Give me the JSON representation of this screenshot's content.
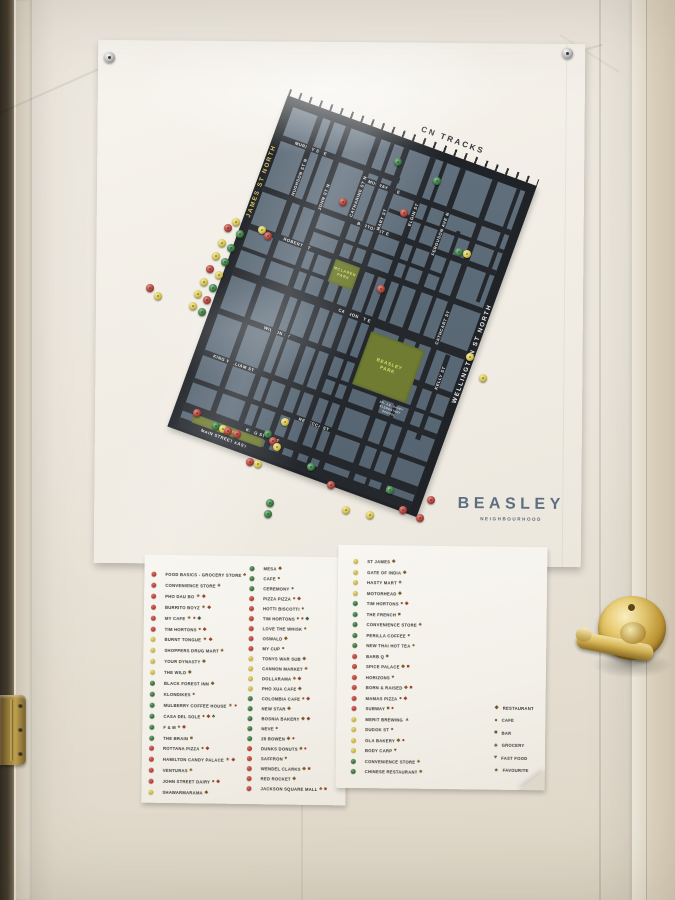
{
  "poster": {
    "title": "BEASLEY",
    "subtitle": "NEIGHBOURHOOD",
    "map": {
      "railway_label": "CN TRACKS",
      "edge_left": "JAMES ST NORTH",
      "edge_right": "WELLINGTON ST NORTH",
      "h_streets": [
        {
          "y": 30,
          "t": 6,
          "x0": 0,
          "x1": 125,
          "label": "MURRAY ST E",
          "lx": 14
        },
        {
          "y": 41,
          "t": 6,
          "x0": 88,
          "x1": 247,
          "label": "MURRAY ST E",
          "lx": 96
        },
        {
          "y": 62,
          "t": 4,
          "x0": 125,
          "x1": 247
        },
        {
          "y": 84,
          "t": 6,
          "x0": 0,
          "x1": 247,
          "label": "BARTON ST E",
          "lx": 100
        },
        {
          "y": 106,
          "t": 4,
          "x0": 60,
          "x1": 200
        },
        {
          "y": 124,
          "t": 6,
          "x0": 0,
          "x1": 247,
          "label": "ROBERT ST",
          "lx": 36
        },
        {
          "y": 148,
          "t": 4,
          "x0": 0,
          "x1": 92
        },
        {
          "y": 170,
          "t": 9,
          "x0": 0,
          "x1": 247,
          "label": "CANNON ST E",
          "lx": 112
        },
        {
          "y": 214,
          "t": 6,
          "x0": 0,
          "x1": 247,
          "label": "WILSON ST",
          "lx": 48
        },
        {
          "y": 240,
          "t": 4,
          "x0": 120,
          "x1": 247
        },
        {
          "y": 258,
          "t": 6,
          "x0": 0,
          "x1": 247,
          "label": "KING WILLIAM ST",
          "lx": 10
        },
        {
          "y": 288,
          "t": 5,
          "x0": 0,
          "x1": 247,
          "label": "REBECCA ST",
          "lx": 112
        },
        {
          "y": 314,
          "t": 9,
          "x0": 0,
          "x1": 247,
          "label": "KING ST EAST",
          "lx": 66
        },
        {
          "y": 330,
          "t": 10,
          "x0": 0,
          "x1": 247,
          "label": "MAIN STREET EAST",
          "lx": 24
        }
      ],
      "v_streets": [
        {
          "x": 26,
          "t": 6,
          "label": "HUGHSON ST N",
          "ly": 44
        },
        {
          "x": 40,
          "t": 4,
          "y0": 0,
          "y1": 124
        },
        {
          "x": 56,
          "t": 6,
          "label": "JOHN ST N",
          "ly": 60
        },
        {
          "x": 70,
          "t": 4,
          "y0": 124,
          "y1": 334
        },
        {
          "x": 88,
          "t": 6,
          "label": "CATHARINE ST N",
          "ly": 40
        },
        {
          "x": 104,
          "t": 4,
          "y0": 0,
          "y1": 334
        },
        {
          "x": 118,
          "t": 6,
          "label": "MARY ST",
          "ly": 64
        },
        {
          "x": 134,
          "t": 4,
          "y0": 124,
          "y1": 334
        },
        {
          "x": 146,
          "t": 6,
          "label": "ELGIN ST",
          "ly": 48
        },
        {
          "x": 160,
          "t": 4,
          "y0": 0,
          "y1": 170
        },
        {
          "x": 178,
          "t": 6,
          "label": "FERGUSON AVE N",
          "ly": 46
        },
        {
          "x": 196,
          "t": 4,
          "y0": 60,
          "y1": 334
        },
        {
          "x": 212,
          "t": 6,
          "label": "CATHCART ST",
          "ly": 138
        },
        {
          "x": 228,
          "t": 5,
          "y0": 180,
          "y1": 270,
          "label": "KELLY ST",
          "ly": 192
        },
        {
          "x": 238,
          "t": 4,
          "y0": 0,
          "y1": 120
        }
      ],
      "parks": [
        {
          "x": 92,
          "y": 128,
          "w": 26,
          "h": 24,
          "lines": [
            "MCLAREN",
            "PARK"
          ],
          "small": true
        },
        {
          "x": 150,
          "y": 184,
          "w": 57,
          "h": 56,
          "lines": [
            "BEASLEY",
            "PARK"
          ],
          "small": false
        },
        {
          "x": 12,
          "y": 322,
          "w": 74,
          "h": 9,
          "lines": [
            "GORE PARK"
          ],
          "small": true
        }
      ],
      "note": {
        "x": 182,
        "y": 246,
        "lines": [
          "DR. J.E. DAVEY",
          "ELEMENTARY",
          "SCHOOL"
        ]
      },
      "pins": [
        [
          236,
          222,
          "y"
        ],
        [
          228,
          228,
          "r"
        ],
        [
          240,
          234,
          "g"
        ],
        [
          222,
          243,
          "y"
        ],
        [
          231,
          248,
          "g"
        ],
        [
          216,
          256,
          "y"
        ],
        [
          225,
          262,
          "g"
        ],
        [
          210,
          269,
          "r"
        ],
        [
          219,
          275,
          "y"
        ],
        [
          204,
          282,
          "y"
        ],
        [
          213,
          288,
          "g"
        ],
        [
          198,
          294,
          "y"
        ],
        [
          207,
          300,
          "r"
        ],
        [
          193,
          306,
          "y"
        ],
        [
          202,
          312,
          "g"
        ],
        [
          150,
          288,
          "r"
        ],
        [
          158,
          296,
          "y"
        ],
        [
          262,
          230,
          "y"
        ],
        [
          268,
          236,
          "r"
        ],
        [
          343,
          202,
          "r"
        ],
        [
          398,
          162,
          "g"
        ],
        [
          404,
          213,
          "r"
        ],
        [
          437,
          181,
          "g"
        ],
        [
          459,
          252,
          "g"
        ],
        [
          467,
          254,
          "y"
        ],
        [
          381,
          289,
          "r"
        ],
        [
          470,
          357,
          "y"
        ],
        [
          483,
          378,
          "y"
        ],
        [
          197,
          413,
          "r"
        ],
        [
          216,
          426,
          "g"
        ],
        [
          223,
          429,
          "y"
        ],
        [
          228,
          431,
          "r"
        ],
        [
          237,
          434,
          "r"
        ],
        [
          250,
          462,
          "r"
        ],
        [
          258,
          464,
          "y"
        ],
        [
          268,
          434,
          "g"
        ],
        [
          273,
          441,
          "r"
        ],
        [
          277,
          447,
          "y"
        ],
        [
          285,
          422,
          "y"
        ],
        [
          270,
          503,
          "g"
        ],
        [
          268,
          514,
          "g"
        ],
        [
          311,
          467,
          "g"
        ],
        [
          331,
          485,
          "r"
        ],
        [
          346,
          510,
          "y"
        ],
        [
          370,
          515,
          "y"
        ],
        [
          390,
          490,
          "g"
        ],
        [
          403,
          510,
          "r"
        ],
        [
          420,
          518,
          "r"
        ],
        [
          431,
          500,
          "r"
        ]
      ]
    }
  },
  "sheets": {
    "left": {
      "columns": [
        {
          "x": 7,
          "tx": 9,
          "y0": 20,
          "dy": 10.9,
          "items": [
            [
              "r",
              "FOOD BASICS - GROCERY STORE",
              "♣"
            ],
            [
              "r",
              "CONVENIENCE STORE",
              "♣"
            ],
            [
              "r",
              "PHO DAU BO",
              "★◆"
            ],
            [
              "r",
              "BURRITO BOYZ",
              "★◆"
            ],
            [
              "r",
              "MY CAFE",
              "★●◆"
            ],
            [
              "r",
              "TIM HORTONS",
              "●◆"
            ],
            [
              "y",
              "BURNT TONGUE",
              "★◆"
            ],
            [
              "y",
              "SHOPPERS DRUG MART",
              "♣"
            ],
            [
              "y",
              "YOUR DYNASTY",
              "◆"
            ],
            [
              "y",
              "THE WILD",
              "◆"
            ],
            [
              "g",
              "BLACK FOREST INN",
              "◆"
            ],
            [
              "g",
              "KLONDIKES",
              "●"
            ],
            [
              "g",
              "MULBERRY COFFEE HOUSE",
              "★●"
            ],
            [
              "g",
              "CASA DEL SOLE",
              "●◆♣"
            ],
            [
              "g",
              "F & M",
              "●◆"
            ],
            [
              "g",
              "THE BRAIN",
              "■"
            ],
            [
              "r",
              "ROTTANA PIZZA",
              "●◆"
            ],
            [
              "r",
              "HAMILTON CANDY PALACE",
              "★◆"
            ],
            [
              "r",
              "VENTURAS",
              "♣"
            ],
            [
              "r",
              "JOHN STREET DAIRY",
              "●◆"
            ],
            [
              "y",
              "SHAWARMARAMA",
              "◆"
            ]
          ]
        },
        {
          "x": 105,
          "tx": 9,
          "y0": 13,
          "dy": 10.0,
          "items": [
            [
              "g",
              "MESA",
              "◆"
            ],
            [
              "g",
              "CAFE",
              "●"
            ],
            [
              "g",
              "CEREMONY",
              "●"
            ],
            [
              "r",
              "PIZZA PIZZA",
              "●◆"
            ],
            [
              "r",
              "HOTTI BISCOTTI",
              "●"
            ],
            [
              "r",
              "TIM HORTONS",
              "●●◆"
            ],
            [
              "r",
              "LOVE THE WHISK",
              "●"
            ],
            [
              "r",
              "OSWALD",
              "◆"
            ],
            [
              "r",
              "MY CUP",
              "●"
            ],
            [
              "y",
              "TONYS WAR SUB",
              "◆"
            ],
            [
              "y",
              "CANNON MARKET",
              "♣"
            ],
            [
              "y",
              "DOLLARAMA",
              "♣◆"
            ],
            [
              "y",
              "PHO XUA CAFE",
              "◆"
            ],
            [
              "g",
              "COLOMBIA CAFE",
              "●◆"
            ],
            [
              "g",
              "NEW STAR",
              "◆"
            ],
            [
              "g",
              "BOSNIA BAKERY",
              "◆◆"
            ],
            [
              "g",
              "NEVE",
              "●"
            ],
            [
              "g",
              "28 BOWEN",
              "◆●"
            ],
            [
              "r",
              "DUNKS DONUTS",
              "■●"
            ],
            [
              "r",
              "SAFFRON",
              "♥"
            ],
            [
              "r",
              "WENDEL CLARKS",
              "◆■"
            ],
            [
              "r",
              "RED ROCKET",
              "◆"
            ],
            [
              "r",
              "JACKSON SQUARE MALL",
              "♣■"
            ]
          ]
        }
      ]
    },
    "right": {
      "columns": [
        {
          "x": 15,
          "tx": 9,
          "y0": 17,
          "dy": 10.5,
          "items": [
            [
              "y",
              "ST JAMES",
              "◆"
            ],
            [
              "y",
              "GATE OF INDIA",
              "◆"
            ],
            [
              "y",
              "HASTY MART",
              "♣"
            ],
            [
              "y",
              "MOTORHEAD",
              "◆"
            ],
            [
              "g",
              "TIM HORTONS",
              "●◆"
            ],
            [
              "g",
              "THE FRENCH",
              "■"
            ],
            [
              "g",
              "CONVENIENCE STORE",
              "♣"
            ],
            [
              "g",
              "PERILLA COFFEE",
              "●"
            ],
            [
              "g",
              "NEW THAI HOT TEA",
              "●"
            ],
            [
              "r",
              "BARB Q",
              "■"
            ],
            [
              "r",
              "SPICE PALACE",
              "◆■"
            ],
            [
              "r",
              "HORIZONS",
              "♥"
            ],
            [
              "r",
              "BORN & RAISED",
              "◆■"
            ],
            [
              "r",
              "MAMAS PIZZA",
              "●◆"
            ],
            [
              "r",
              "SUBWAY",
              "■●"
            ],
            [
              "y",
              "MERIT BREWING",
              "▲"
            ],
            [
              "y",
              "DUDOK ST",
              "●"
            ],
            [
              "y",
              "OLA BAKERY",
              "◆●"
            ],
            [
              "y",
              "BODY CARP",
              "♥"
            ],
            [
              "g",
              "CONVENIENCE STORE",
              "♣"
            ],
            [
              "g",
              "CHINESE RESTAURANT",
              "■"
            ]
          ]
        }
      ],
      "key": {
        "x": 158,
        "y0": 158,
        "dy": 12.5,
        "items": [
          [
            "◆",
            "RESTAURANT"
          ],
          [
            "●",
            "CAFE"
          ],
          [
            "■",
            "BAR"
          ],
          [
            "♣",
            "GROCERY"
          ],
          [
            "♥",
            "FAST FOOD"
          ],
          [
            "★",
            "FAVOURITE"
          ]
        ]
      }
    }
  }
}
